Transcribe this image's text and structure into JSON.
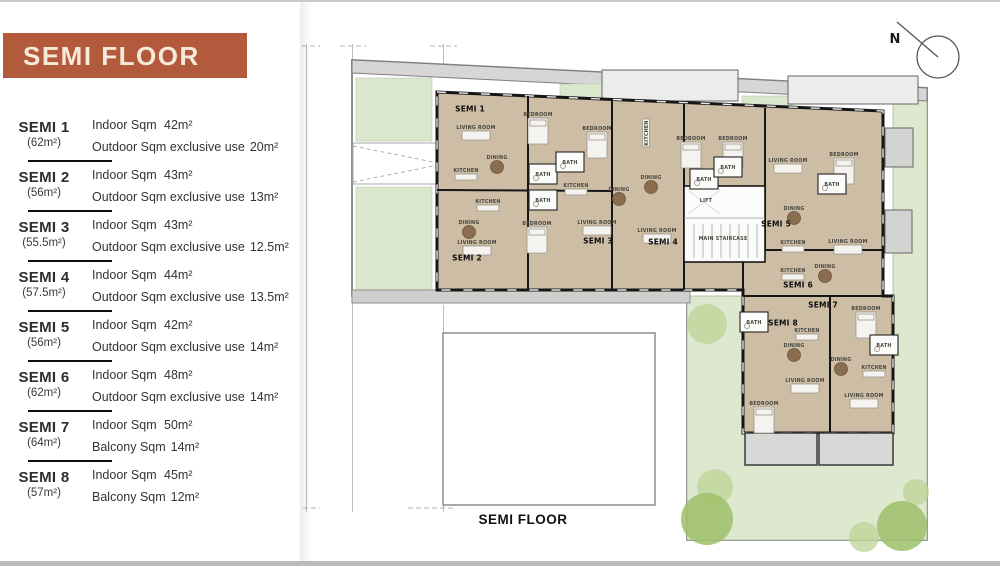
{
  "page": {
    "top_border_color": "#c9c9c9",
    "bottom_border_color": "#b9bdb9",
    "background": "#ffffff"
  },
  "panel": {
    "title": "SEMI FLOOR",
    "banner_color": "#b45a3c",
    "units": [
      {
        "name": "SEMI 1",
        "size": "(62m²)",
        "line1_label": "Indoor Sqm",
        "line1_value": "42m²",
        "line2_label": "Outdoor Sqm exclusive use",
        "line2_value": "20m²"
      },
      {
        "name": "SEMI 2",
        "size": "(56m²)",
        "line1_label": "Indoor Sqm",
        "line1_value": "43m²",
        "line2_label": "Outdoor Sqm exclusive use",
        "line2_value": "13m²"
      },
      {
        "name": "SEMI 3",
        "size": "(55.5m²)",
        "line1_label": "Indoor Sqm",
        "line1_value": "43m²",
        "line2_label": "Outdoor Sqm exclusive use",
        "line2_value": "12.5m²"
      },
      {
        "name": "SEMI 4",
        "size": "(57.5m²)",
        "line1_label": "Indoor Sqm",
        "line1_value": "44m²",
        "line2_label": "Outdoor Sqm exclusive use",
        "line2_value": "13.5m²"
      },
      {
        "name": "SEMI 5",
        "size": "(56m²)",
        "line1_label": "Indoor Sqm",
        "line1_value": "42m²",
        "line2_label": "Outdoor Sqm exclusive use",
        "line2_value": "14m²"
      },
      {
        "name": "SEMI 6",
        "size": "(62m²)",
        "line1_label": "Indoor Sqm",
        "line1_value": "48m²",
        "line2_label": "Outdoor Sqm exclusive use",
        "line2_value": "14m²"
      },
      {
        "name": "SEMI 7",
        "size": "(64m²)",
        "line1_label": "Indoor Sqm",
        "line1_value": "50m²",
        "line2_label": "Balcony Sqm",
        "line2_value": "14m²"
      },
      {
        "name": "SEMI 8",
        "size": "(57m²)",
        "line1_label": "Indoor Sqm",
        "line1_value": "45m²",
        "line2_label": "Balcony Sqm",
        "line2_value": "12m²"
      }
    ]
  },
  "plan": {
    "caption": "SEMI FLOOR",
    "compass_label": "N",
    "colors": {
      "floor": "#cdbda5",
      "wall": "#161616",
      "garden": "#dde8cf",
      "sidewalk": "#d6d6d4",
      "tree_dark": "#9dc06a",
      "tree_light": "#bcd495",
      "banner": "#b45a3c"
    },
    "unit_labels": [
      {
        "text": "SEMI 1",
        "x": 470,
        "y": 109
      },
      {
        "text": "SEMI 2",
        "x": 467,
        "y": 258
      },
      {
        "text": "SEMI 3",
        "x": 598,
        "y": 241
      },
      {
        "text": "SEMI 4",
        "x": 663,
        "y": 242
      },
      {
        "text": "SEMI 5",
        "x": 776,
        "y": 224
      },
      {
        "text": "SEMI 6",
        "x": 798,
        "y": 285
      },
      {
        "text": "SEMI 7",
        "x": 823,
        "y": 305
      },
      {
        "text": "SEMI 8",
        "x": 783,
        "y": 323
      }
    ],
    "room_labels": [
      {
        "text": "LIVING ROOM",
        "x": 476,
        "y": 127
      },
      {
        "text": "DINING",
        "x": 497,
        "y": 157
      },
      {
        "text": "KITCHEN",
        "x": 466,
        "y": 170
      },
      {
        "text": "BEDROOM",
        "x": 538,
        "y": 114
      },
      {
        "text": "BATH",
        "x": 543,
        "y": 174
      },
      {
        "text": "KITCHEN",
        "x": 488,
        "y": 201
      },
      {
        "text": "DINING",
        "x": 469,
        "y": 222
      },
      {
        "text": "LIVING ROOM",
        "x": 477,
        "y": 242
      },
      {
        "text": "BATH",
        "x": 543,
        "y": 200
      },
      {
        "text": "BEDROOM",
        "x": 537,
        "y": 223
      },
      {
        "text": "BEDROOM",
        "x": 597,
        "y": 128
      },
      {
        "text": "BATH",
        "x": 570,
        "y": 162
      },
      {
        "text": "KITCHEN",
        "x": 576,
        "y": 185
      },
      {
        "text": "DINING",
        "x": 619,
        "y": 189
      },
      {
        "text": "LIVING ROOM",
        "x": 597,
        "y": 222
      },
      {
        "text": "KITCHEN",
        "x": 646,
        "y": 133,
        "vertical": true
      },
      {
        "text": "BEDROOM",
        "x": 691,
        "y": 138
      },
      {
        "text": "DINING",
        "x": 651,
        "y": 177
      },
      {
        "text": "BATH",
        "x": 704,
        "y": 179
      },
      {
        "text": "LIVING ROOM",
        "x": 657,
        "y": 230
      },
      {
        "text": "BEDROOM",
        "x": 733,
        "y": 138
      },
      {
        "text": "BATH",
        "x": 728,
        "y": 167
      },
      {
        "text": "LIFT",
        "x": 706,
        "y": 200
      },
      {
        "text": "MAIN STAIRCASE",
        "x": 723,
        "y": 238
      },
      {
        "text": "LIVING ROOM",
        "x": 788,
        "y": 160
      },
      {
        "text": "DINING",
        "x": 794,
        "y": 208
      },
      {
        "text": "KITCHEN",
        "x": 793,
        "y": 242
      },
      {
        "text": "BEDROOM",
        "x": 844,
        "y": 154
      },
      {
        "text": "BATH",
        "x": 832,
        "y": 184
      },
      {
        "text": "LIVING ROOM",
        "x": 848,
        "y": 241
      },
      {
        "text": "KITCHEN",
        "x": 793,
        "y": 270
      },
      {
        "text": "DINING",
        "x": 825,
        "y": 266
      },
      {
        "text": "BEDROOM",
        "x": 866,
        "y": 308
      },
      {
        "text": "BATH",
        "x": 884,
        "y": 345
      },
      {
        "text": "KITCHEN",
        "x": 874,
        "y": 367
      },
      {
        "text": "DINING",
        "x": 841,
        "y": 359
      },
      {
        "text": "LIVING ROOM",
        "x": 864,
        "y": 395
      },
      {
        "text": "BATH",
        "x": 754,
        "y": 322
      },
      {
        "text": "KITCHEN",
        "x": 807,
        "y": 330
      },
      {
        "text": "DINING",
        "x": 794,
        "y": 345
      },
      {
        "text": "LIVING ROOM",
        "x": 805,
        "y": 380
      },
      {
        "text": "BEDROOM",
        "x": 764,
        "y": 403
      }
    ]
  }
}
